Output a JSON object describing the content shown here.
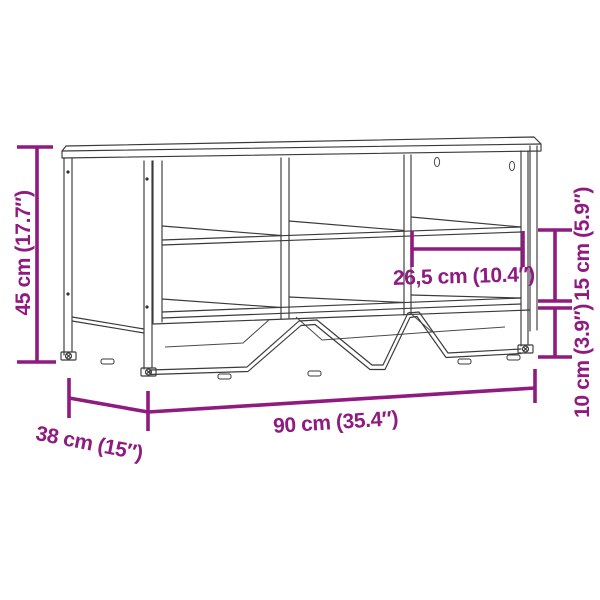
{
  "diagram": {
    "kind": "furniture-dimension-line-drawing",
    "subject": "shoe storage bench with six open compartments and metal frame legs",
    "colors": {
      "accent": "#8F1A80",
      "line": "#3A3A3A",
      "background": "#FFFFFF"
    },
    "dimensions": {
      "height": {
        "label": "45 cm (17.7″)"
      },
      "width": {
        "label": "90 cm (35.4″)"
      },
      "depth": {
        "label": "38 cm (15″)"
      },
      "compartment_width": {
        "label": "26,5 cm (10.4″)"
      },
      "compartment_height": {
        "label": "15 cm (5.9″)"
      },
      "leg_height": {
        "label": "10 cm (3.9″)"
      }
    }
  }
}
